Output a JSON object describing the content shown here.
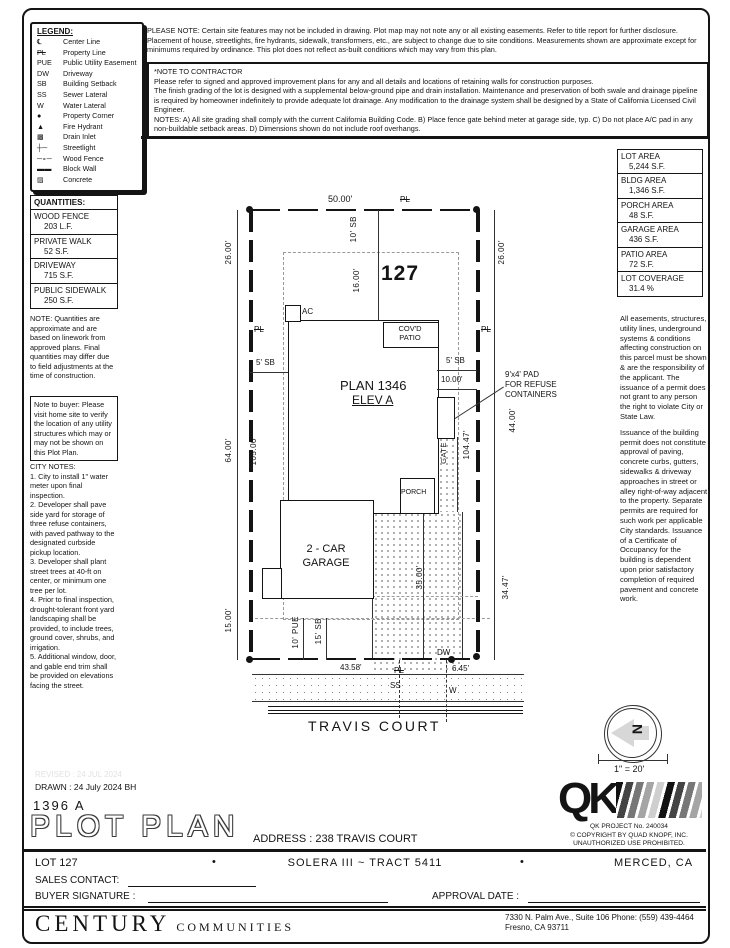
{
  "legend": {
    "title": "LEGEND:",
    "items": [
      {
        "sym": "℄",
        "label": "Center Line"
      },
      {
        "sym": "PL",
        "label": "Property Line"
      },
      {
        "sym": "PUE",
        "label": "Public Utility Easement"
      },
      {
        "sym": "DW",
        "label": "Driveway"
      },
      {
        "sym": "SB",
        "label": "Building Setback"
      },
      {
        "sym": "SS",
        "label": "Sewer Lateral"
      },
      {
        "sym": "W",
        "label": "Water Lateral"
      },
      {
        "sym": "●",
        "label": "Property Corner"
      },
      {
        "sym": "▲",
        "label": "Fire Hydrant"
      },
      {
        "sym": "▩",
        "label": "Drain Inlet"
      },
      {
        "sym": "┼─",
        "label": "Streetlight"
      },
      {
        "sym": "─∘─",
        "label": "Wood Fence"
      },
      {
        "sym": "▬▬",
        "label": "Block Wall"
      },
      {
        "sym": "▨",
        "label": "Concrete"
      }
    ]
  },
  "top_notes": {
    "please_note": "PLEASE NOTE:  Certain site features may not be included in drawing.  Plot map may not note any or all existing easements. Refer to title report for further disclosure.  Placement of house, streetlights, fire hydrants, sidewalk, transformers, etc., are subject to change due to site conditions.  Measurements shown are approximate except for minimums required by ordinance.  This plot does not reflect as-built conditions which may vary from this plan.",
    "contractor_title": "*NOTE TO CONTRACTOR",
    "contractor_p1": "Please refer to signed and approved improvement plans for any and all details and locations of retaining walls for construction purposes.",
    "contractor_p2": "The finish grading of the lot is designed with a supplemental below-ground pipe and drain installation.  Maintenance and preservation of both swale and drainage pipeline is required by homeowner indefinitely to provide adequate lot drainage.  Any modification to the drainage system shall be designed by a State of California Licensed Civil Engineer.",
    "contractor_p3": "NOTES:  A) All site grading shall comply with the current California Building Code.  B) Place fence gate behind meter at garage side, typ.  C) Do not place A/C pad in any non-buildable setback areas.  D) Dimensions shown do not include roof overhangs."
  },
  "quantities": {
    "title": "QUANTITIES:",
    "items": [
      {
        "label": "WOOD FENCE",
        "value": "203 L.F."
      },
      {
        "label": "PRIVATE WALK",
        "value": "52 S.F."
      },
      {
        "label": "DRIVEWAY",
        "value": "715 S.F."
      },
      {
        "label": "PUBLIC SIDEWALK",
        "value": "250 S.F."
      }
    ],
    "note": "NOTE: Quantities are approximate and are based on linework from approved plans.  Final quantities may differ due to field adjustments at the time of construction."
  },
  "buyer_note": "Note to buyer: Please visit home site to verify the location of any utility structures which may or may not be shown on this Plot Plan.",
  "city_notes": {
    "title": "CITY NOTES:",
    "body": "1. City to install 1\" water meter upon final inspection.\n2. Developer shall pave side yard for storage of three refuse containers, with paved pathway to the designated curbside pickup location.\n3. Developer shall plant street trees at 40-ft on center, or minimum one tree per lot.\n4. Prior to final inspection, drought-tolerant front yard landscaping shall be provided, to include trees, ground cover, shrubs, and irrigation.\n5. Additional window, door, and gable end trim shall be provided on elevations facing the street."
  },
  "areas": [
    {
      "label": "LOT AREA",
      "value": "5,244 S.F."
    },
    {
      "label": "BLDG AREA",
      "value": "1,346 S.F."
    },
    {
      "label": "PORCH AREA",
      "value": "48 S.F."
    },
    {
      "label": "GARAGE AREA",
      "value": "436 S.F."
    },
    {
      "label": "PATIO AREA",
      "value": "72 S.F."
    },
    {
      "label": "LOT COVERAGE",
      "value": "31.4 %"
    }
  ],
  "agency_notes": {
    "p1": "All easements, structures, utility lines, underground systems & conditions affecting construction on this parcel must be shown & are the responsibility of the applicant. The issuance of a permit does not grant to any person the right to violate City or State Law.",
    "p2": "Issuance of the building permit does not constitute approval of paving, concrete curbs, gutters, sidewalks & driveway approaches in street or alley right-of-way adjacent to the property. Separate permits are required for such work per applicable City standards. Issuance of a Certificate of Occupancy for the building is dependent upon prior satisfactory completion of required pavement and concrete work."
  },
  "plot": {
    "lot_number": "127",
    "plan_name": "PLAN 1346",
    "elevation": "ELEV A",
    "covd_patio": "COV'D\nPATIO",
    "ac": "AC",
    "gate": "GATE",
    "porch": "PORCH",
    "garage": "2 - CAR\nGARAGE",
    "refuse_callout": "9'x4' PAD\nFOR REFUSE\nCONTAINERS",
    "street_name": "TRAVIS COURT",
    "scale": "1\" = 20'",
    "north": "N",
    "dims": {
      "top_width": "50.00'",
      "pl": "PL",
      "left_26": "26.00'",
      "right_26": "26.00'",
      "sb_10": "10' SB",
      "d16": "16.00'",
      "sb5_left": "5' SB",
      "sb5_right": "5' SB",
      "d10": "10.00'",
      "d44": "44.00'",
      "d64": "64.00'",
      "d105": "105.00'",
      "d104": "104.47'",
      "d35": "35.00'",
      "d15": "15.00'",
      "pue10": "10' PUE",
      "sb15": "15' SB",
      "d4358": "43.58'",
      "d645": "6.45'",
      "dw": "DW",
      "d3447": "34.47'",
      "ss": "SS",
      "w": "W"
    }
  },
  "titleblock": {
    "revised": "REVISED :  24 JUL 2024",
    "drawn": "DRAWN :  24 July 2024  BH",
    "plan_number": "1396  A",
    "title": "PLOT PLAN",
    "address": "ADDRESS :  238 TRAVIS COURT",
    "lot": "LOT 127",
    "bullet": "•",
    "tract": "SOLERA III ~ TRACT 5411",
    "city": "MERCED, CA",
    "sales_contact": "SALES CONTACT:",
    "buyer_signature": "BUYER SIGNATURE :",
    "approval_date": "APPROVAL DATE :",
    "brand": "CENTURY",
    "brand2": "COMMUNITIES",
    "office_line1": "7330 N. Palm Ave., Suite 106    Phone:  (559) 439-4464",
    "office_line2": "Fresno, CA  93711",
    "qk": "QK",
    "qk_project": "QK PROJECT No. 240034",
    "qk_copyright": "©  COPYRIGHT BY QUAD KNOPF, INC.",
    "qk_unauthorized": "UNAUTHORIZED USE PROHIBITED."
  }
}
